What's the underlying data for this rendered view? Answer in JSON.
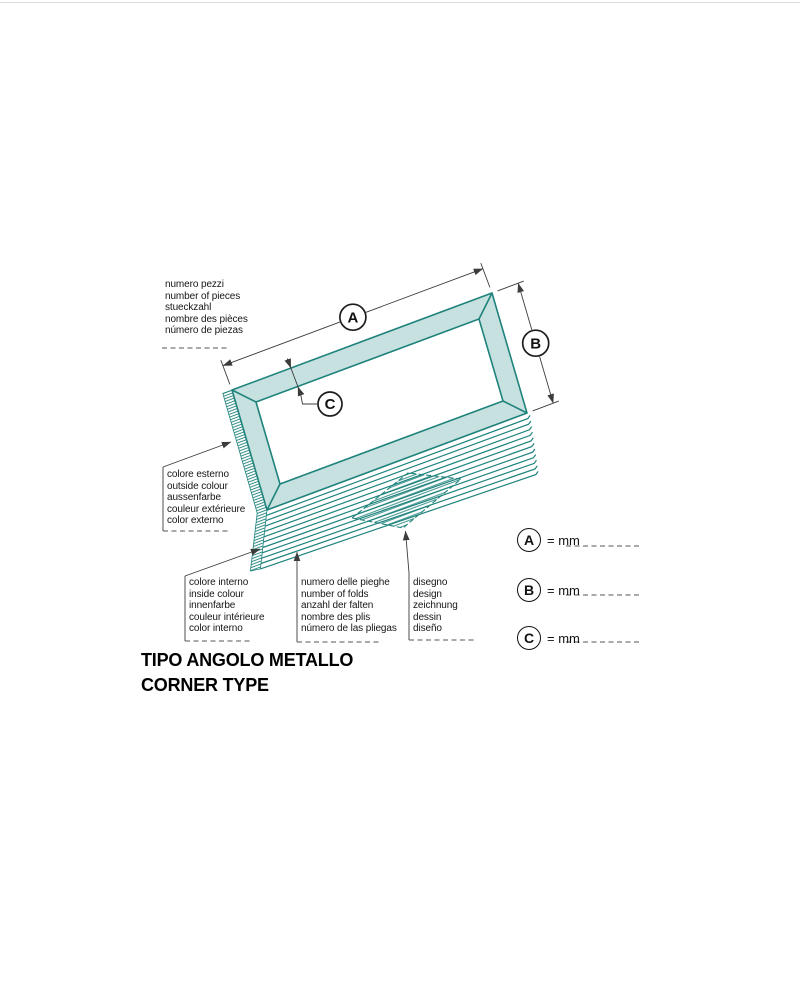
{
  "title": {
    "line1": "TIPO ANGOLO METALLO",
    "line2": "CORNER TYPE"
  },
  "labels": {
    "pieces": "numero pezzi\nnumber of pieces\nstueckzahl\nnombre des pièces\nnúmero de piezas",
    "outside_colour": "colore esterno\noutside colour\naussenfarbe\ncouleur extérieure\ncolor externo",
    "inside_colour": "colore interno\ninside colour\ninnenfarbe\ncouleur intérieure\ncolor interno",
    "folds": "numero delle pieghe\nnumber of folds\nanzahl der falten\nnombre des plis\nnúmero de las pliegas",
    "design": "disegno\ndesign\nzeichnung\ndessin\ndiseño"
  },
  "diagram": {
    "dim_a_label": "A",
    "dim_b_label": "B",
    "dim_c_label": "C"
  },
  "dim_rows": [
    {
      "letter": "A",
      "value_label": "= mm"
    },
    {
      "letter": "B",
      "value_label": "= mm"
    },
    {
      "letter": "C",
      "value_label": "= mm"
    }
  ],
  "colors": {
    "frame_fill": "#c6e1e0",
    "frame_stroke": "#1f837c",
    "line": "#3c3c3c",
    "text": "#161616"
  }
}
